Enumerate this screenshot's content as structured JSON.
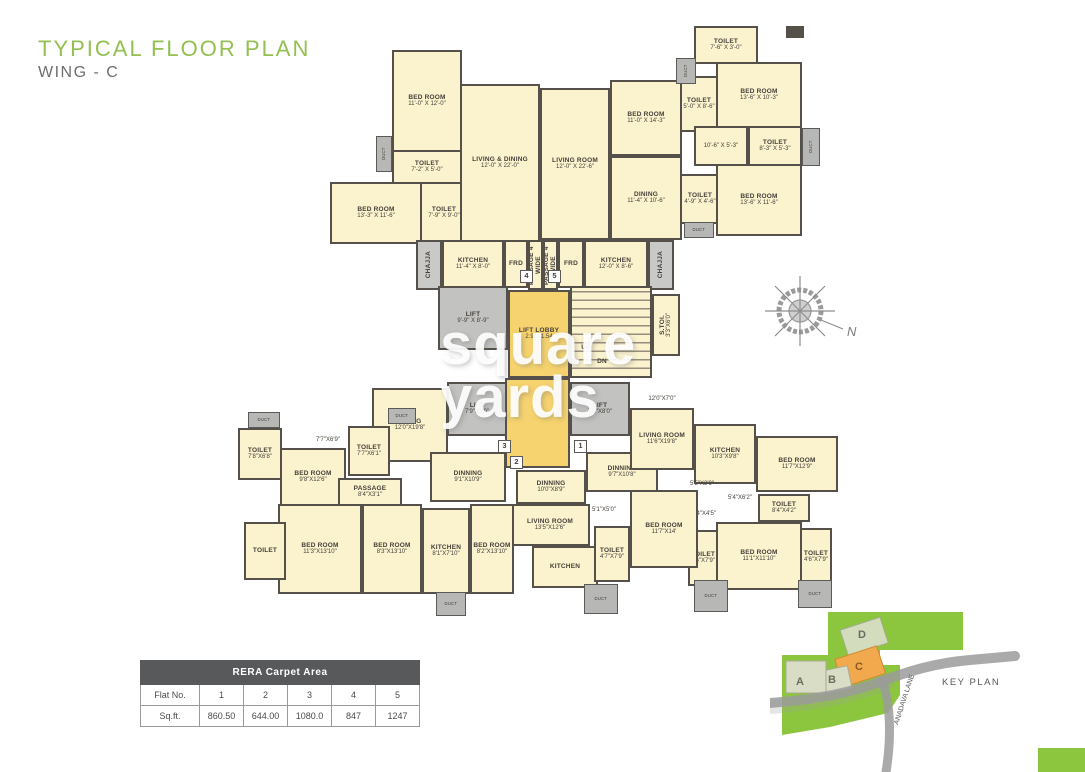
{
  "title": {
    "main": "TYPICAL FLOOR PLAN",
    "sub": "WING - C"
  },
  "watermark": {
    "line1": "square",
    "line2": "yards"
  },
  "compass": {
    "north_label": "N"
  },
  "table": {
    "title": "RERA Carpet Area",
    "rows": [
      [
        "Flat No.",
        "1",
        "2",
        "3",
        "4",
        "5"
      ],
      [
        "Sq.ft.",
        "860.50",
        "644.00",
        "1080.0",
        "847",
        "1247"
      ]
    ]
  },
  "key_plan": {
    "label": "KEY PLAN",
    "road_label": "ANADAVA LANE",
    "buildings": [
      {
        "name": "A",
        "highlight": false
      },
      {
        "name": "B",
        "highlight": false
      },
      {
        "name": "C",
        "highlight": true
      },
      {
        "name": "D",
        "highlight": false
      }
    ],
    "colors": {
      "site": "#8CC63F",
      "building": "#DADDC6",
      "highlight": "#F2A94E",
      "road": "#9b9b9b"
    }
  },
  "floor_plan": {
    "colors": {
      "room": "#FBF2CE",
      "wall": "#55504a",
      "duct": "#b7b7b5",
      "lobby": "#F6D36E",
      "lift": "#c2c2c0"
    },
    "rooms": [
      {
        "id": "duct",
        "n": "DUCT",
        "t": "duct",
        "v": 1,
        "x": 376,
        "y": 136,
        "w": 16,
        "h": 36
      },
      {
        "id": "bedroom",
        "n": "BED ROOM",
        "d": "11'-0\" X 12'-0\"",
        "x": 392,
        "y": 50,
        "w": 70,
        "h": 102
      },
      {
        "id": "toilet",
        "n": "TOILET",
        "d": "7'-2\" X 5'-0\"",
        "x": 392,
        "y": 150,
        "w": 70,
        "h": 34
      },
      {
        "id": "bedroom",
        "n": "BED ROOM",
        "d": "13'-3\" X 11'-6\"",
        "x": 330,
        "y": 182,
        "w": 92,
        "h": 62
      },
      {
        "id": "toilet",
        "n": "TOILET",
        "d": "7'-9\" X 9'-0\"",
        "x": 420,
        "y": 182,
        "w": 48,
        "h": 62
      },
      {
        "id": "living-dining",
        "n": "LIVING & DINING",
        "d": "12'-0\" X 22'-0\"",
        "x": 460,
        "y": 84,
        "w": 80,
        "h": 158
      },
      {
        "id": "chajja",
        "n": "CHAJJA",
        "t": "service",
        "v": 1,
        "x": 416,
        "y": 240,
        "w": 26,
        "h": 50
      },
      {
        "id": "kitchen",
        "n": "KITCHEN",
        "d": "11'-4\" X 8'-0\"",
        "x": 442,
        "y": 240,
        "w": 62,
        "h": 48
      },
      {
        "id": "fridge",
        "n": "FRD",
        "x": 504,
        "y": 240,
        "w": 24,
        "h": 48
      },
      {
        "id": "passage",
        "n": "PASSAGE 4' WIDE",
        "v": 1,
        "x": 528,
        "y": 240,
        "w": 15,
        "h": 50
      },
      {
        "id": "passage",
        "n": "PASSAGE 4' WIDE",
        "v": 1,
        "x": 543,
        "y": 240,
        "w": 15,
        "h": 50
      },
      {
        "id": "fridge",
        "n": "FRD",
        "x": 558,
        "y": 240,
        "w": 26,
        "h": 48
      },
      {
        "id": "kitchen",
        "n": "KITCHEN",
        "d": "12'-0\" X 8'-6\"",
        "x": 584,
        "y": 240,
        "w": 64,
        "h": 48
      },
      {
        "id": "chajja",
        "n": "CHAJJA",
        "t": "service",
        "v": 1,
        "x": 648,
        "y": 240,
        "w": 26,
        "h": 50
      },
      {
        "id": "living-room",
        "n": "LIVING ROOM",
        "d": "12'-0\" X 22'-6\"",
        "x": 540,
        "y": 88,
        "w": 70,
        "h": 152
      },
      {
        "id": "bedroom",
        "n": "BED ROOM",
        "d": "11'-0\" X 14'-3\"",
        "x": 610,
        "y": 80,
        "w": 72,
        "h": 76
      },
      {
        "id": "toilet",
        "n": "TOILET",
        "d": "5'-0\" X 8'-6\"",
        "x": 680,
        "y": 76,
        "w": 38,
        "h": 56
      },
      {
        "id": "dining",
        "n": "DINING",
        "d": "11'-4\" X 10'-6\"",
        "x": 610,
        "y": 156,
        "w": 72,
        "h": 84
      },
      {
        "id": "toilet",
        "n": "TOILET",
        "d": "4'-9\" X 4'-6\"",
        "x": 680,
        "y": 174,
        "w": 40,
        "h": 50
      },
      {
        "id": "duct",
        "n": "DUCT",
        "t": "duct",
        "x": 684,
        "y": 222,
        "w": 30,
        "h": 16
      },
      {
        "id": "toilet",
        "n": "TOILET",
        "d": "7'-6\" X 3'-0\"",
        "x": 694,
        "y": 26,
        "w": 64,
        "h": 38
      },
      {
        "id": "duct",
        "n": "DUCT",
        "t": "duct",
        "v": 1,
        "x": 676,
        "y": 58,
        "w": 20,
        "h": 26
      },
      {
        "id": "bedroom",
        "n": "BED ROOM",
        "d": "13'-6\" X 10'-3\"",
        "x": 716,
        "y": 62,
        "w": 86,
        "h": 66
      },
      {
        "id": "balcony",
        "d": "10'-6\" X 5'-3\"",
        "x": 694,
        "y": 126,
        "w": 54,
        "h": 40
      },
      {
        "id": "toilet",
        "n": "TOILET",
        "d": "8'-3\" X 5'-3\"",
        "x": 748,
        "y": 126,
        "w": 54,
        "h": 40
      },
      {
        "id": "duct",
        "n": "DUCT",
        "t": "duct",
        "v": 1,
        "x": 802,
        "y": 128,
        "w": 18,
        "h": 38
      },
      {
        "id": "bedroom",
        "n": "BED ROOM",
        "d": "13'-6\" X 11'-6\"",
        "x": 716,
        "y": 164,
        "w": 86,
        "h": 72
      },
      {
        "id": "column",
        "t": "wall",
        "x": 786,
        "y": 26,
        "w": 18,
        "h": 12
      },
      {
        "id": "lift",
        "n": "LIFT",
        "d": "9'-9\" X 8'-9\"",
        "t": "lift",
        "x": 438,
        "y": 286,
        "w": 70,
        "h": 64
      },
      {
        "id": "lift-lobby",
        "n": "LIFT LOBBY",
        "d": "2.91X1.54",
        "t": "lobby",
        "x": 508,
        "y": 290,
        "w": 62,
        "h": 88
      },
      {
        "id": "staircase",
        "t": "stair",
        "x": 570,
        "y": 286,
        "w": 82,
        "h": 92
      },
      {
        "id": "stair-up-label",
        "n": "UP",
        "t": "label",
        "x": 576,
        "y": 342,
        "w": 20,
        "h": 12
      },
      {
        "id": "stair-dn-label",
        "n": "DN",
        "t": "label",
        "x": 592,
        "y": 356,
        "w": 20,
        "h": 12
      },
      {
        "id": "servant-toilet",
        "n": "S.TOI.",
        "d": "3'3\"X6'0\"",
        "v": 1,
        "x": 652,
        "y": 294,
        "w": 28,
        "h": 62
      },
      {
        "id": "flat-number-4",
        "n": "4",
        "t": "marker",
        "x": 520,
        "y": 270,
        "w": 13,
        "h": 13
      },
      {
        "id": "flat-number-5",
        "n": "5",
        "t": "marker",
        "x": 548,
        "y": 270,
        "w": 13,
        "h": 13
      },
      {
        "id": "lift-lobby",
        "t": "lobby",
        "x": 505,
        "y": 378,
        "w": 65,
        "h": 90
      },
      {
        "id": "lift",
        "n": "LIFT",
        "d": "7'9\"X8'0\"",
        "t": "lift",
        "x": 447,
        "y": 382,
        "w": 60,
        "h": 54
      },
      {
        "id": "lift",
        "n": "LIFT",
        "d": "7'6\"X8'0\"",
        "t": "lift",
        "x": 570,
        "y": 382,
        "w": 60,
        "h": 54
      },
      {
        "id": "flat-number-3",
        "n": "3",
        "t": "marker",
        "x": 498,
        "y": 440,
        "w": 13,
        "h": 13
      },
      {
        "id": "flat-number-1",
        "n": "1",
        "t": "marker",
        "x": 574,
        "y": 440,
        "w": 13,
        "h": 13
      },
      {
        "id": "flat-number-2",
        "n": "2",
        "t": "marker",
        "x": 510,
        "y": 456,
        "w": 13,
        "h": 13
      },
      {
        "id": "duct",
        "n": "DUCT",
        "t": "duct",
        "x": 248,
        "y": 412,
        "w": 32,
        "h": 16
      },
      {
        "id": "toilet",
        "n": "TOILET",
        "d": "7'8\"X6'8\"",
        "x": 238,
        "y": 428,
        "w": 44,
        "h": 52
      },
      {
        "id": "bedroom",
        "n": "BED ROOM",
        "d": "9'8\"X12'6\"",
        "x": 280,
        "y": 448,
        "w": 66,
        "h": 58
      },
      {
        "id": "living",
        "n": "LIVING",
        "d": "12'0\"X19'8\"",
        "x": 372,
        "y": 388,
        "w": 76,
        "h": 74
      },
      {
        "id": "toilet",
        "n": "TOILET",
        "d": "7'7\"X6'1\"",
        "x": 348,
        "y": 426,
        "w": 42,
        "h": 50
      },
      {
        "id": "dim-label",
        "d": "7'7\"X6'9\"",
        "t": "label",
        "x": 306,
        "y": 434,
        "w": 44,
        "h": 13
      },
      {
        "id": "duct",
        "n": "DUCT",
        "t": "duct",
        "x": 388,
        "y": 408,
        "w": 28,
        "h": 16
      },
      {
        "id": "passage",
        "n": "PASSAGE",
        "d": "8'4\"X3'1\"",
        "x": 338,
        "y": 478,
        "w": 64,
        "h": 28
      },
      {
        "id": "dinning",
        "n": "DINNING",
        "d": "9'1\"X10'9\"",
        "x": 430,
        "y": 452,
        "w": 76,
        "h": 50
      },
      {
        "id": "dinning",
        "n": "DINNING",
        "d": "10'0\"X8'9\"",
        "x": 516,
        "y": 470,
        "w": 70,
        "h": 34
      },
      {
        "id": "dinning",
        "n": "DINNING",
        "d": "9'7\"X10'8\"",
        "x": 586,
        "y": 452,
        "w": 72,
        "h": 40
      },
      {
        "id": "balcony",
        "d": "12'0\"X7'0\"",
        "t": "label",
        "x": 630,
        "y": 392,
        "w": 64,
        "h": 14
      },
      {
        "id": "living-room",
        "n": "LIVING ROOM",
        "d": "11'6\"X19'8\"",
        "x": 630,
        "y": 408,
        "w": 64,
        "h": 62
      },
      {
        "id": "kitchen",
        "n": "KITCHEN",
        "d": "10'3\"X9'8\"",
        "x": 694,
        "y": 424,
        "w": 62,
        "h": 60
      },
      {
        "id": "bedroom",
        "n": "BED ROOM",
        "d": "11'7\"X12'9\"",
        "x": 756,
        "y": 436,
        "w": 82,
        "h": 56
      },
      {
        "id": "dim-label",
        "d": "5'5\"X3'9\"",
        "t": "label",
        "x": 678,
        "y": 478,
        "w": 48,
        "h": 13
      },
      {
        "id": "dim-label",
        "d": "5'4\"X6'2\"",
        "t": "label",
        "x": 714,
        "y": 492,
        "w": 52,
        "h": 13
      },
      {
        "id": "dim-label",
        "d": "5'4\"X4'5\"",
        "t": "label",
        "x": 680,
        "y": 508,
        "w": 48,
        "h": 13
      },
      {
        "id": "toilet",
        "n": "TOILET",
        "d": "8'4\"X4'2\"",
        "x": 758,
        "y": 494,
        "w": 52,
        "h": 28
      },
      {
        "id": "bedroom",
        "n": "BED ROOM",
        "d": "11'1\"X11'10\"",
        "x": 716,
        "y": 522,
        "w": 86,
        "h": 68
      },
      {
        "id": "toilet",
        "n": "TOILET",
        "d": "4'6\"X7'9\"",
        "x": 688,
        "y": 530,
        "w": 30,
        "h": 56
      },
      {
        "id": "toilet",
        "n": "TOILET",
        "d": "4'6\"X7'9\"",
        "x": 800,
        "y": 528,
        "w": 32,
        "h": 58
      },
      {
        "id": "duct",
        "n": "DUCT",
        "t": "duct",
        "x": 694,
        "y": 580,
        "w": 34,
        "h": 32
      },
      {
        "id": "duct",
        "n": "DUCT",
        "t": "duct",
        "x": 798,
        "y": 580,
        "w": 34,
        "h": 28
      },
      {
        "id": "bedroom",
        "n": "BED ROOM",
        "d": "11'7\"X14'",
        "x": 630,
        "y": 490,
        "w": 68,
        "h": 78
      },
      {
        "id": "living-room",
        "n": "LIVING ROOM",
        "d": "13'5\"X12'6\"",
        "x": 510,
        "y": 504,
        "w": 80,
        "h": 42
      },
      {
        "id": "dim-label",
        "d": "5'1\"X5'0\"",
        "t": "label",
        "x": 584,
        "y": 504,
        "w": 40,
        "h": 13
      },
      {
        "id": "kitchen",
        "n": "KITCHEN",
        "x": 532,
        "y": 546,
        "w": 66,
        "h": 42
      },
      {
        "id": "toilet",
        "n": "TOILET",
        "d": "4'7\"X7'9\"",
        "x": 594,
        "y": 526,
        "w": 36,
        "h": 56
      },
      {
        "id": "duct",
        "n": "DUCT",
        "t": "duct",
        "x": 584,
        "y": 584,
        "w": 34,
        "h": 30
      },
      {
        "id": "bedroom",
        "n": "BED ROOM",
        "d": "11'3\"X13'10\"",
        "x": 278,
        "y": 504,
        "w": 84,
        "h": 90
      },
      {
        "id": "bedroom",
        "n": "BED ROOM",
        "d": "8'3\"X13'10\"",
        "x": 362,
        "y": 504,
        "w": 60,
        "h": 90
      },
      {
        "id": "kitchen",
        "n": "KITCHEN",
        "d": "8'1\"X7'10\"",
        "x": 422,
        "y": 508,
        "w": 48,
        "h": 86
      },
      {
        "id": "bedroom",
        "n": "BED ROOM",
        "d": "8'2\"X13'10\"",
        "x": 470,
        "y": 504,
        "w": 44,
        "h": 90
      },
      {
        "id": "toilet",
        "n": "TOILET",
        "x": 244,
        "y": 522,
        "w": 42,
        "h": 58
      },
      {
        "id": "duct",
        "n": "DUCT",
        "t": "duct",
        "x": 436,
        "y": 592,
        "w": 30,
        "h": 24
      }
    ]
  }
}
